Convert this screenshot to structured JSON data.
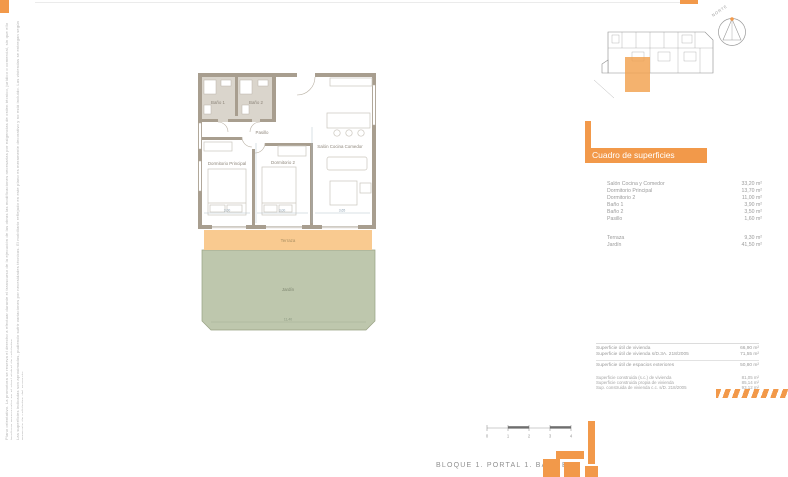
{
  "accent_color": "#F2994A",
  "header": {
    "compass_label": "NORTE"
  },
  "floor_plan": {
    "rooms": {
      "bano1": "Baño 1",
      "bano2": "Baño 2",
      "pasillo": "Pasillo",
      "dorm_ppal": "Dormitorio Principal",
      "dorm2": "Dormitorio 2",
      "salon": "Salón Cocina Comedor",
      "terraza": "Terraza",
      "jardin": "Jardín"
    },
    "dims": {
      "d1": "3,00",
      "d2": "3,00",
      "d3": "3,65",
      "d4": "11,40"
    },
    "fills": {
      "terrace": "#F9CA90",
      "garden": "#BEC7AD",
      "wall": "#A89E8F",
      "bath_floor": "#DAD5CC"
    }
  },
  "surfaces": {
    "title": "Cuadro de superficies",
    "rows": [
      {
        "label": "Salón Cocina y Comedor",
        "value": "33,20 m²"
      },
      {
        "label": "Dormitorio Principal",
        "value": "13,70 m²"
      },
      {
        "label": "Dormitorio 2",
        "value": "11,00 m²"
      },
      {
        "label": "Baño 1",
        "value": "3,90 m²"
      },
      {
        "label": "Baño 2",
        "value": "3,50 m²"
      },
      {
        "label": "Pasillo",
        "value": "1,60 m²"
      }
    ],
    "outdoor": [
      {
        "label": "Terraza",
        "value": "9,30 m²"
      },
      {
        "label": "Jardín",
        "value": "41,50 m²"
      }
    ]
  },
  "summary": {
    "rows": [
      {
        "label": "Superficie útil de vivienda",
        "value": "66,90 m²"
      },
      {
        "label": "Superficie útil de vivienda s/D.3A. 218/2005",
        "value": "71,55 m²"
      },
      {
        "label": "Superficie útil de espacios exteriores",
        "value": "50,80 m²"
      },
      {
        "label": "Superficie construida (s.c.) de vivienda",
        "value": "81,05 m²"
      },
      {
        "label": "Superficie construida propia de vivienda",
        "value": "85,14 m²"
      },
      {
        "label": "Sup. construida de vivienda c.c. s/D. 218/2005",
        "value": "93,12 m²"
      }
    ]
  },
  "scale": {
    "ticks": [
      "0",
      "1",
      "2",
      "3",
      "4"
    ]
  },
  "footer": {
    "title": "BLOQUE 1. PORTAL 1. BAJO B"
  },
  "disclaimer": {
    "col1": "Plano orientativo. La promotora se reserva el derecho a efectuar durante el transcurso de la ejecución de las obras las modificaciones necesarias por exigencias de orden técnico, jurídico o comercial, sin que ello implique menoscabo en el nivel global de calidades.",
    "col2": "Las superficies indicadas son aproximadas, pudiendo sufrir variaciones por necesidades técnicas. El mobiliario reflejado en este plano es meramente decorativo y no está incluido. Las viviendas se entregan según memoria de calidades del proyecto."
  }
}
